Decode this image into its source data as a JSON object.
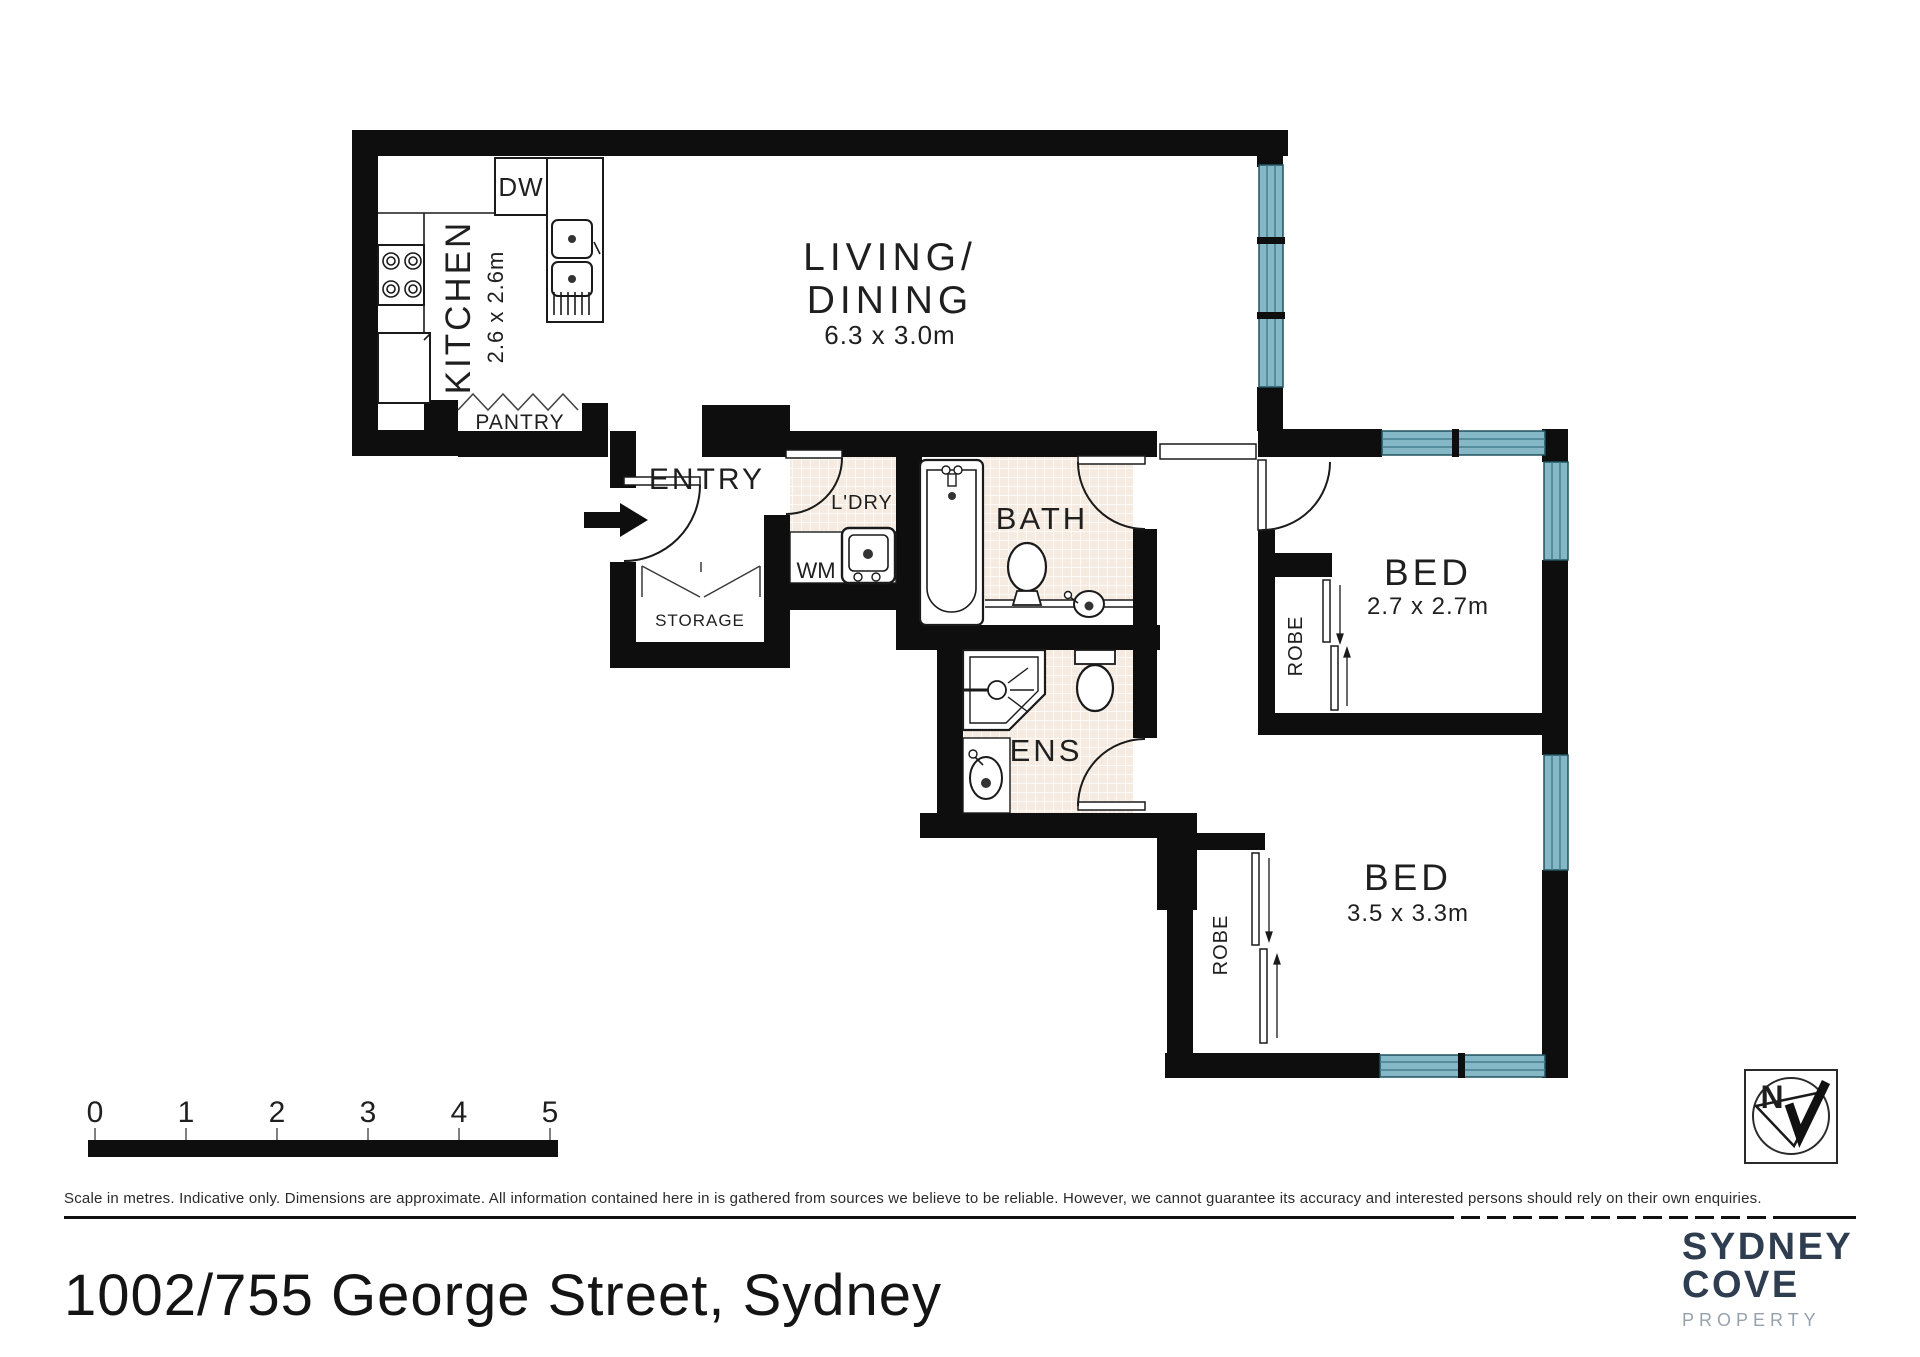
{
  "plan": {
    "labels": {
      "living_line1": "LIVING/",
      "living_line2": "DINING",
      "living_dims": "6.3 x 3.0m",
      "kitchen": "KITCHEN",
      "kitchen_dims": "2.6 x 2.6m",
      "dw": "DW",
      "pantry": "PANTRY",
      "entry": "ENTRY",
      "ldry": "L'DRY",
      "wm": "WM",
      "storage": "STORAGE",
      "bath": "BATH",
      "ens": "ENS",
      "bed1": "BED",
      "bed1_dims": "2.7 x 2.7m",
      "bed2": "BED",
      "bed2_dims": "3.5 x 3.3m",
      "robe1": "ROBE",
      "robe2": "ROBE"
    },
    "colors": {
      "wall": "#0e0e0e",
      "window": "#84b8c6",
      "tile": "#f6ebe0"
    }
  },
  "scale_bar": {
    "ticks": [
      "0",
      "1",
      "2",
      "3",
      "4",
      "5"
    ]
  },
  "compass": {
    "letter": "N"
  },
  "footer": {
    "disclaimer": "Scale in metres. Indicative only. Dimensions are approximate. All information contained here in is gathered from sources we believe to be reliable. However, we cannot guarantee its accuracy and interested persons should rely on their own enquiries.",
    "address": "1002/755 George Street, Sydney"
  },
  "brand": {
    "name_line1": "SYDNEY",
    "name_line2": "COVE",
    "tagline": "PROPERTY"
  }
}
